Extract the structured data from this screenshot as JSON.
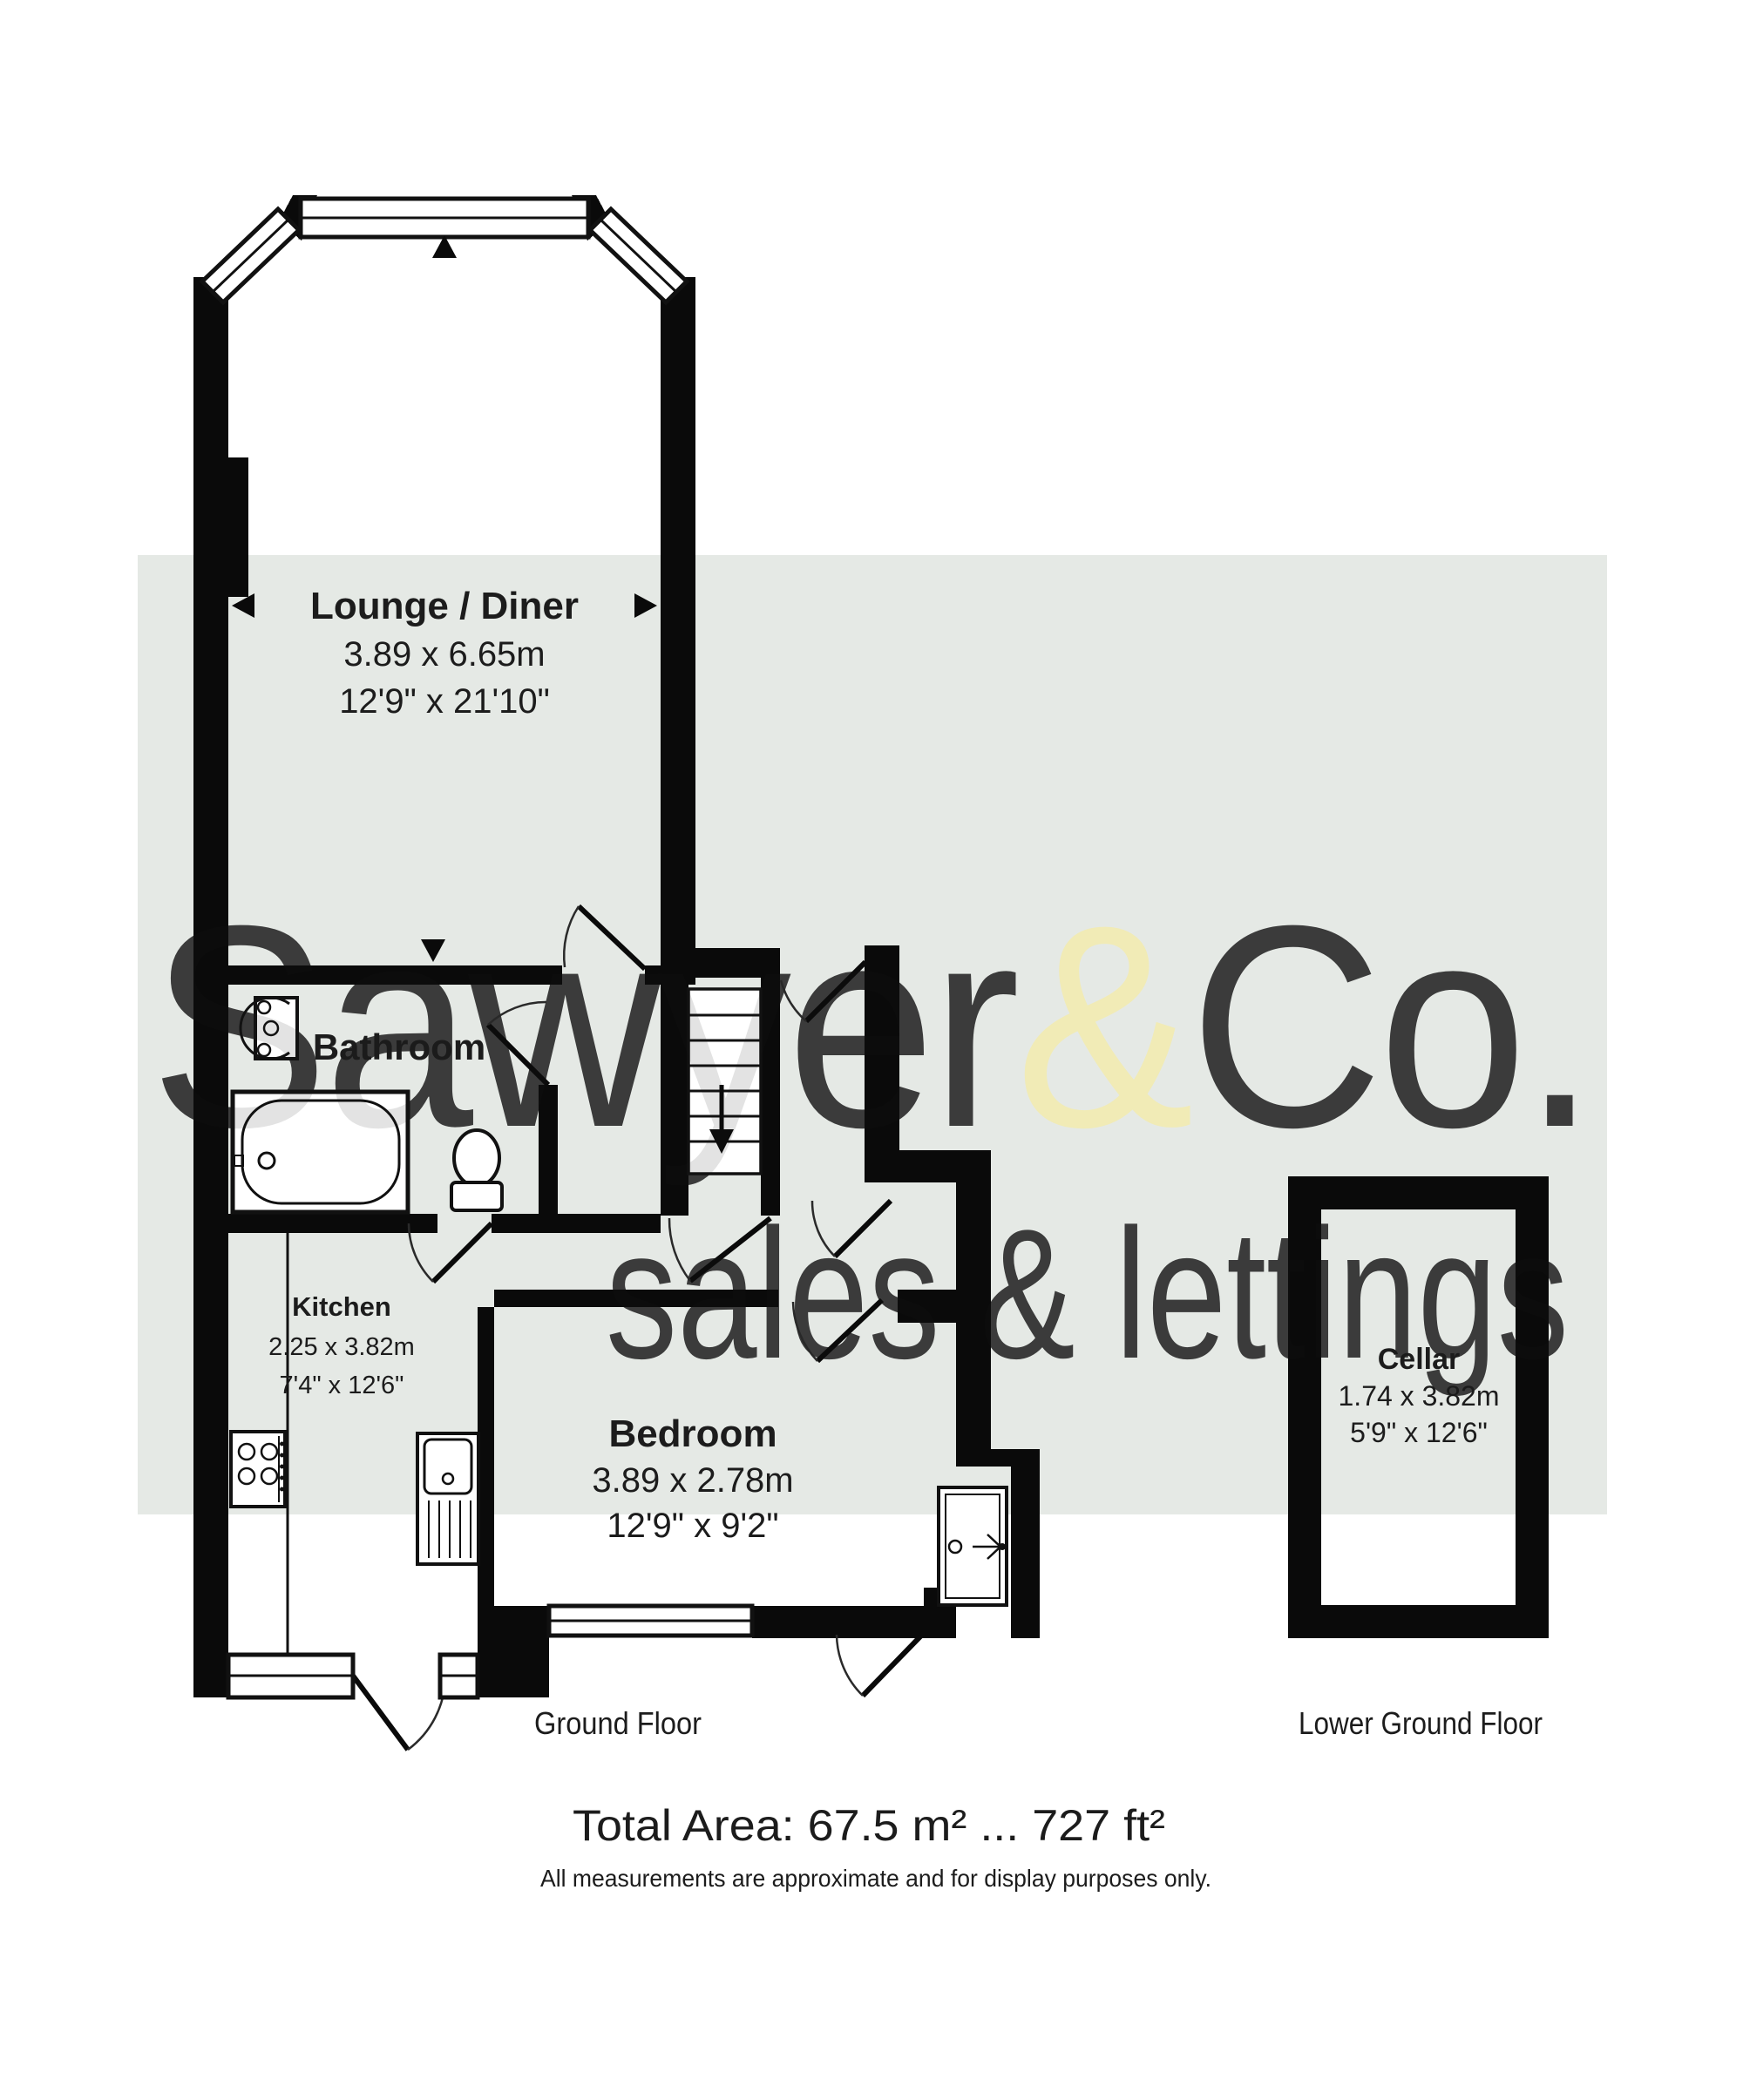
{
  "watermark": {
    "band_color": "#e5e9e5",
    "text_color": "#ffffff",
    "ampersand_color": "#f3ecae",
    "brand_prefix": "Sawyer",
    "brand_amp": "&",
    "brand_suffix": "Co.",
    "tagline": "sales & lettings"
  },
  "rooms": {
    "lounge": {
      "name": "Lounge / Diner",
      "metric": "3.89 x 6.65m",
      "imperial": "12'9\" x 21'10\""
    },
    "bathroom": {
      "name": "Bathroom"
    },
    "kitchen": {
      "name": "Kitchen",
      "metric": "2.25 x 3.82m",
      "imperial": "7'4\" x 12'6\""
    },
    "bedroom": {
      "name": "Bedroom",
      "metric": "3.89 x 2.78m",
      "imperial": "12'9\" x 9'2\""
    },
    "cellar": {
      "name": "Cellar",
      "metric": "1.74 x 3.82m",
      "imperial": "5'9\" x 12'6\""
    }
  },
  "floor_labels": {
    "ground": "Ground Floor",
    "lower_ground": "Lower Ground Floor"
  },
  "footer": {
    "total_area": "Total Area: 67.5 m² ... 727 ft²",
    "disclaimer": "All measurements are approximate and for display purposes only."
  },
  "colors": {
    "wall": "#0a0a0a",
    "band": "#e5e9e5"
  }
}
